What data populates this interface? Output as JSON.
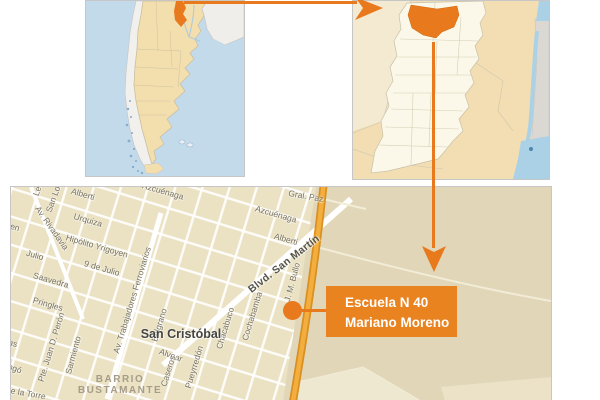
{
  "infographic": {
    "type": "map-locator",
    "accent_color": "#E8791D",
    "country_map": {
      "ocean_color": "#C3DAEB",
      "land_color": "#F3DEAD",
      "neighbor_color": "#F1EFEC",
      "highlight_color": "#E8791D"
    },
    "province_map": {
      "surrounding_fill": "#F2DEB2",
      "province_fill": "#FCF8E9",
      "river_color": "#ABD1E7",
      "highlight_color": "#E8791D"
    },
    "street_map": {
      "background_color": "#E1D7B8",
      "town_fill": "#EBE2C4",
      "road_color": "#FFFFFF",
      "highway_color": "#F4AE3E",
      "town_label": "San Cristóbal",
      "district_label": [
        "BARRIO",
        "BUSTAMANTE"
      ],
      "streets": [
        {
          "name": "Le"
        },
        {
          "name": "San Lo"
        },
        {
          "name": "Alberti"
        },
        {
          "name": "Azcuénaga"
        },
        {
          "name": "Gral. Paz"
        },
        {
          "name": "Urquiza"
        },
        {
          "name": "Av. Rivadavia"
        },
        {
          "name": "en"
        },
        {
          "name": "Hipólito Yrigoyen"
        },
        {
          "name": "Azcuénaga"
        },
        {
          "name": "Alberti"
        },
        {
          "name": "Blvd. San Martín"
        },
        {
          "name": "Julio"
        },
        {
          "name": "9 de Julio"
        },
        {
          "name": "Saavedra"
        },
        {
          "name": "Pringles"
        },
        {
          "name": "Av. Trabajadores Ferroviarios"
        },
        {
          "name": "Pte. Juan D. Perón"
        },
        {
          "name": "Sarmiento"
        },
        {
          "name": "Belgrano"
        },
        {
          "name": "Alvear"
        },
        {
          "name": "Caseros"
        },
        {
          "name": "Pueyrredón"
        },
        {
          "name": "Chacabuco"
        },
        {
          "name": "Cochabamba"
        },
        {
          "name": "J. M. Bullo"
        },
        {
          "name": "as"
        },
        {
          "name": "ingó"
        },
        {
          "name": "de la Torre"
        }
      ]
    },
    "callout": {
      "line1": "Escuela N 40",
      "line2": "Mariano Moreno",
      "bg_color": "#E8831F",
      "text_color": "#FFFFFF"
    }
  }
}
